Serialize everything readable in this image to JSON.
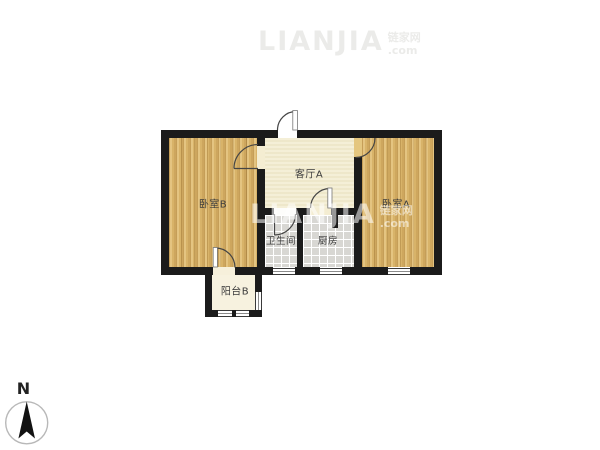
{
  "rooms": {
    "bedroom_b": "卧室B",
    "living_a": "客厅A",
    "bedroom_a": "卧室A",
    "bathroom": "卫生间",
    "kitchen": "厨房",
    "balcony_b": "阳台B"
  },
  "compass": {
    "north_label": "N"
  },
  "watermark": {
    "main": "LIANJIA",
    "side_top": "链家网",
    "side_bottom": ".com"
  },
  "colors": {
    "wall": "#1b1b1b",
    "wood_floor": "#d8b369",
    "living_floor": "#f2ebcd",
    "tile_floor": "#d8d7d3",
    "balcony_floor": "#f7f2df"
  }
}
